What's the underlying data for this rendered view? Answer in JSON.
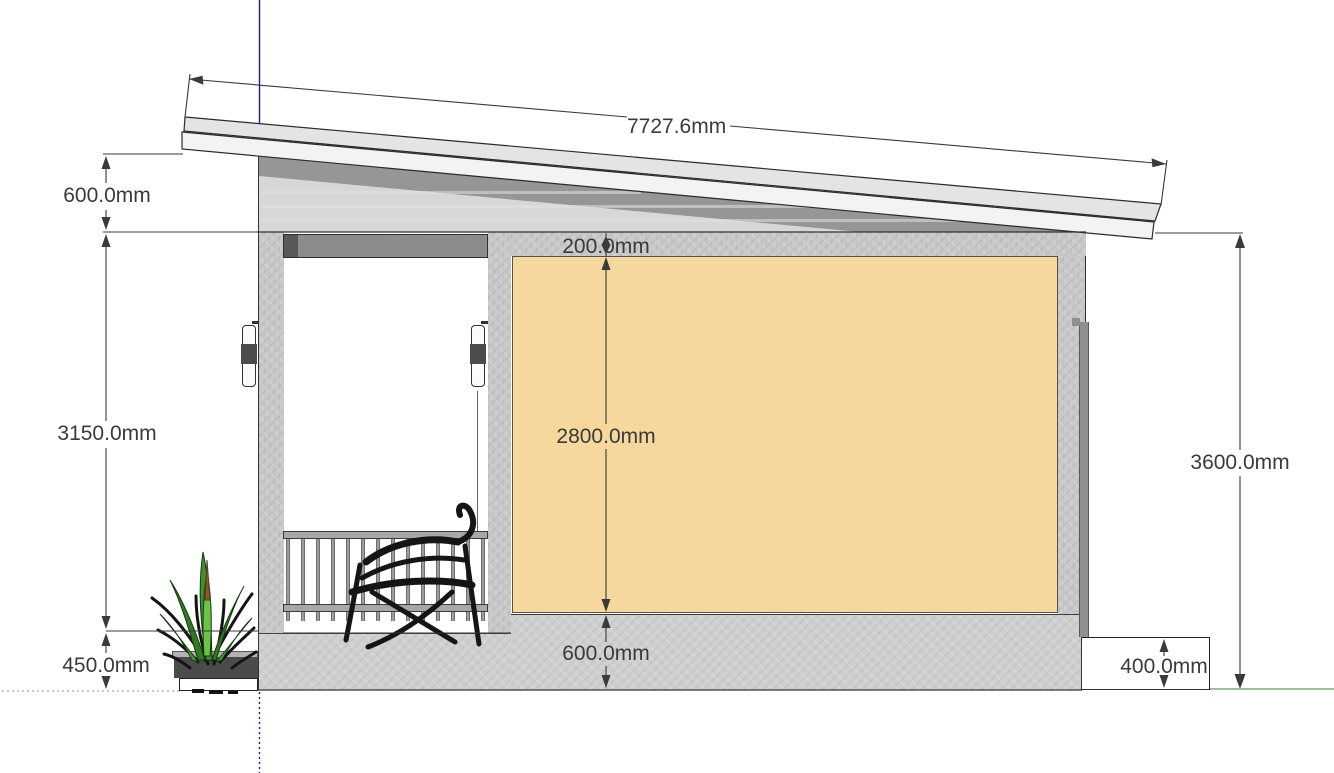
{
  "drawing": {
    "title": "house-side-elevation",
    "dimensions": {
      "roof_slope_length": "7727.6mm",
      "left_eave_height": "600.0mm",
      "left_wall_height": "3150.0mm",
      "left_base_height": "450.0mm",
      "top_band_height": "200.0mm",
      "wall_panel_height": "2800.0mm",
      "plinth_height": "600.0mm",
      "right_total_height": "3600.0mm",
      "right_footing_height": "400.0mm"
    },
    "colors": {
      "wall_panel_orange": "#f6d79c",
      "concrete_gray": "#c9c9c9",
      "eave_gray": "#d7d7d7",
      "shadow_gray": "#969696",
      "header_gray": "#8c8c8c",
      "header_dark": "#585858",
      "axis_blue": "#1a1a9c",
      "ground_green": "#9cc09c",
      "dimension_text": "#3a3a3a",
      "bench_black": "#151515",
      "plant_green": "#3f8f2f"
    }
  }
}
